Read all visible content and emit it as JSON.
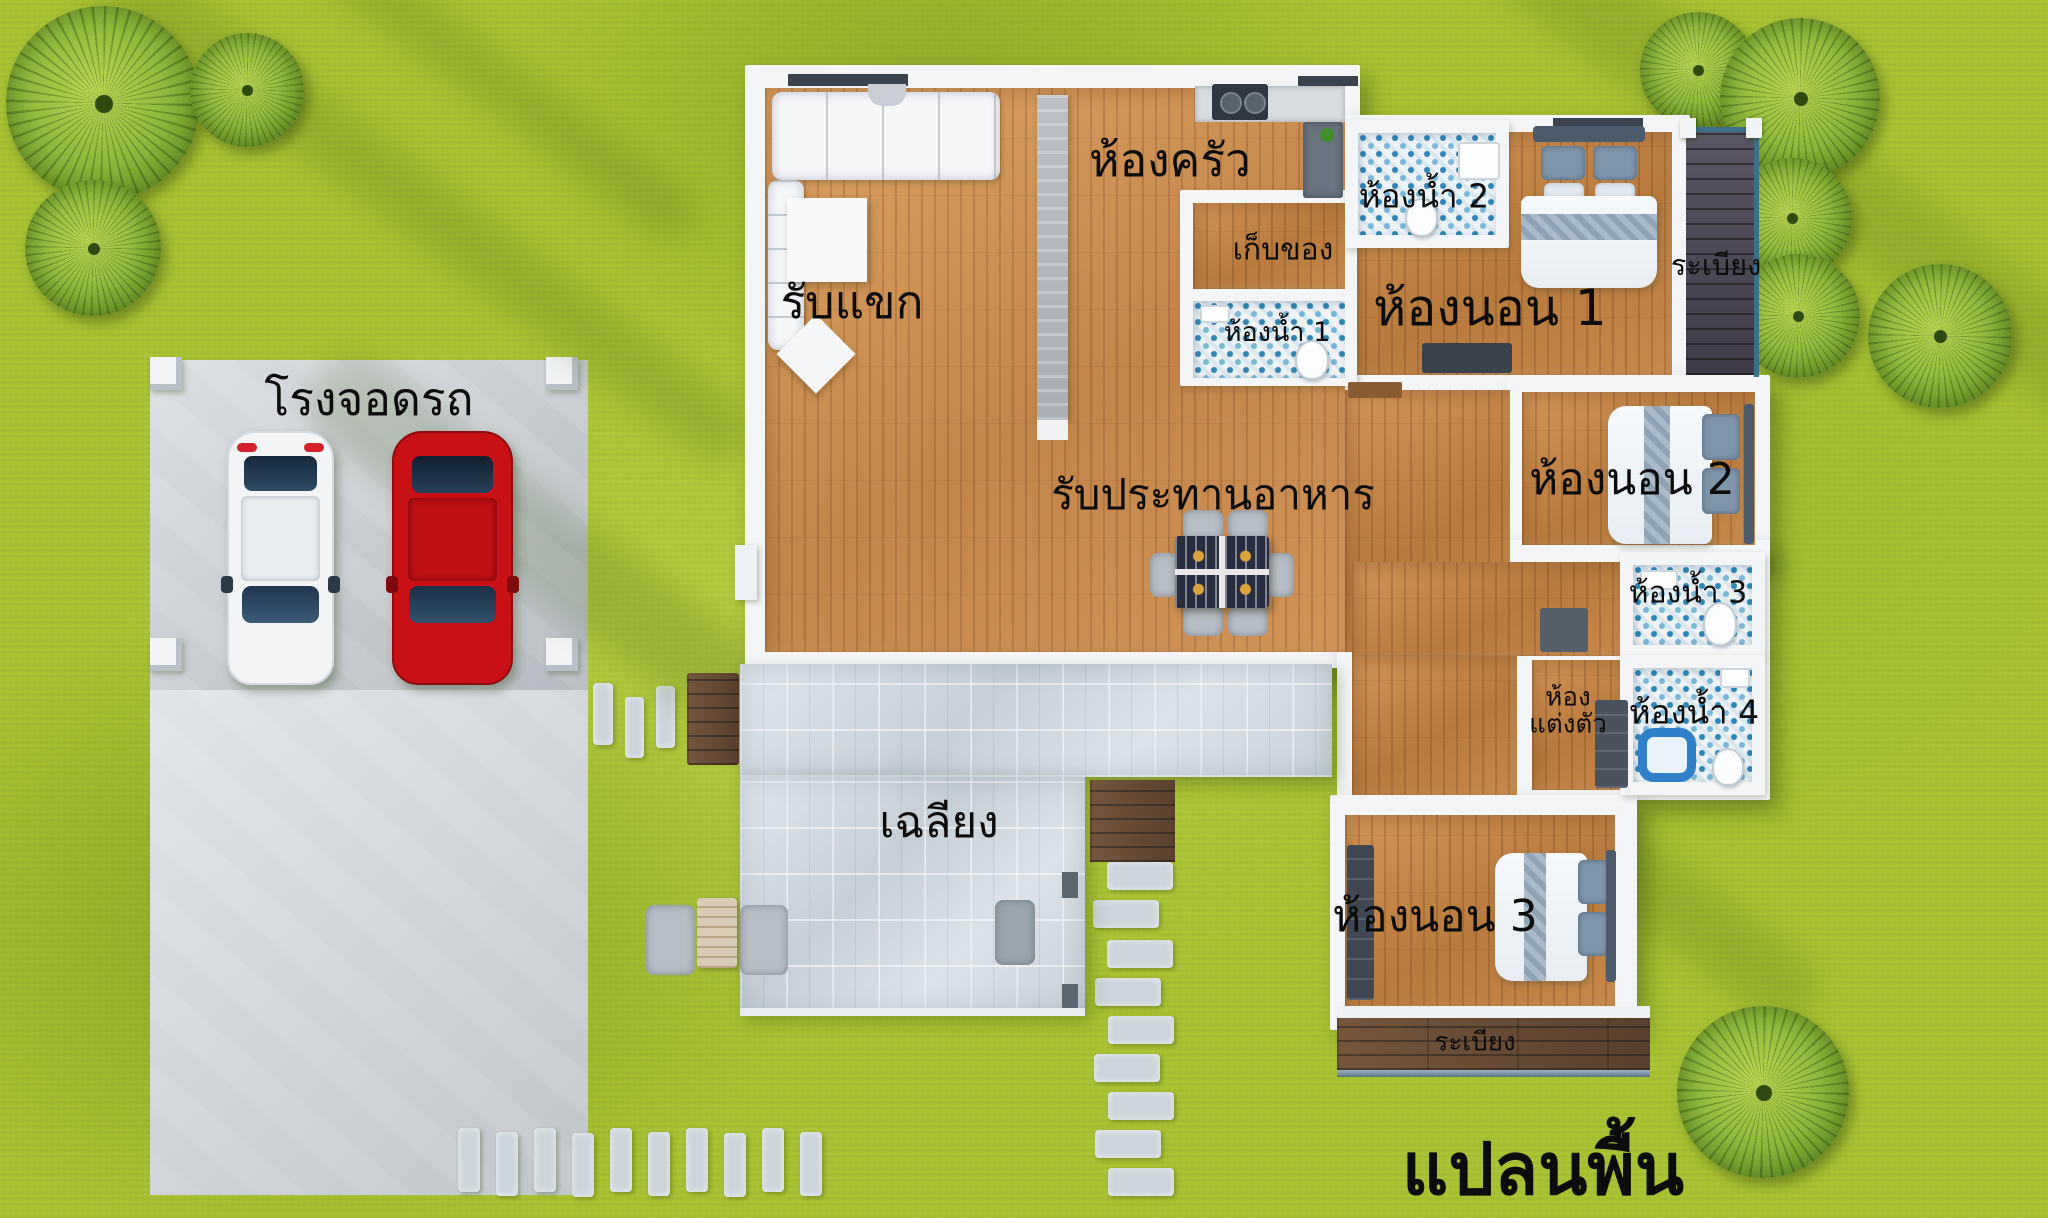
{
  "plan_title": "แปลนพื้น",
  "rooms": {
    "carport": {
      "label": "โรงจอดรถ"
    },
    "living": {
      "label": "รับแขก"
    },
    "kitchen": {
      "label": "ห้องครัว"
    },
    "storage": {
      "label": "เก็บของ"
    },
    "bathroom1": {
      "label": "ห้องน้ำ 1"
    },
    "bathroom2": {
      "label": "ห้องน้ำ 2"
    },
    "bathroom3": {
      "label": "ห้องน้ำ 3"
    },
    "bathroom4": {
      "label": "ห้องน้ำ 4"
    },
    "bedroom1": {
      "label": "ห้องนอน 1"
    },
    "bedroom2": {
      "label": "ห้องนอน 2"
    },
    "bedroom3": {
      "label": "ห้องนอน 3"
    },
    "dining": {
      "label": "รับประทานอาหาร"
    },
    "porch": {
      "label": "เฉลียง"
    },
    "dressing": {
      "label_line1": "ห้อง",
      "label_line2": "แต่งตัว"
    },
    "balcony_right": {
      "label": "ระเบียง"
    },
    "balcony_bottom": {
      "label": "ระเบียง"
    }
  },
  "colors": {
    "grass": "#a9c331",
    "wood_floor": "#c08449",
    "wall_white": "#f3f5f7",
    "bath_tile_blue": "#3a8abb",
    "porch_tile": "#d6dde2",
    "deck_dark": "#4b4650",
    "deck_brown": "#6b4f3a",
    "concrete": "#c9cfd5",
    "car_red": "#c81016",
    "car_white": "#f2f4f6",
    "dining_table_navy": "#272c3e",
    "label_text": "#0c0c0c"
  }
}
